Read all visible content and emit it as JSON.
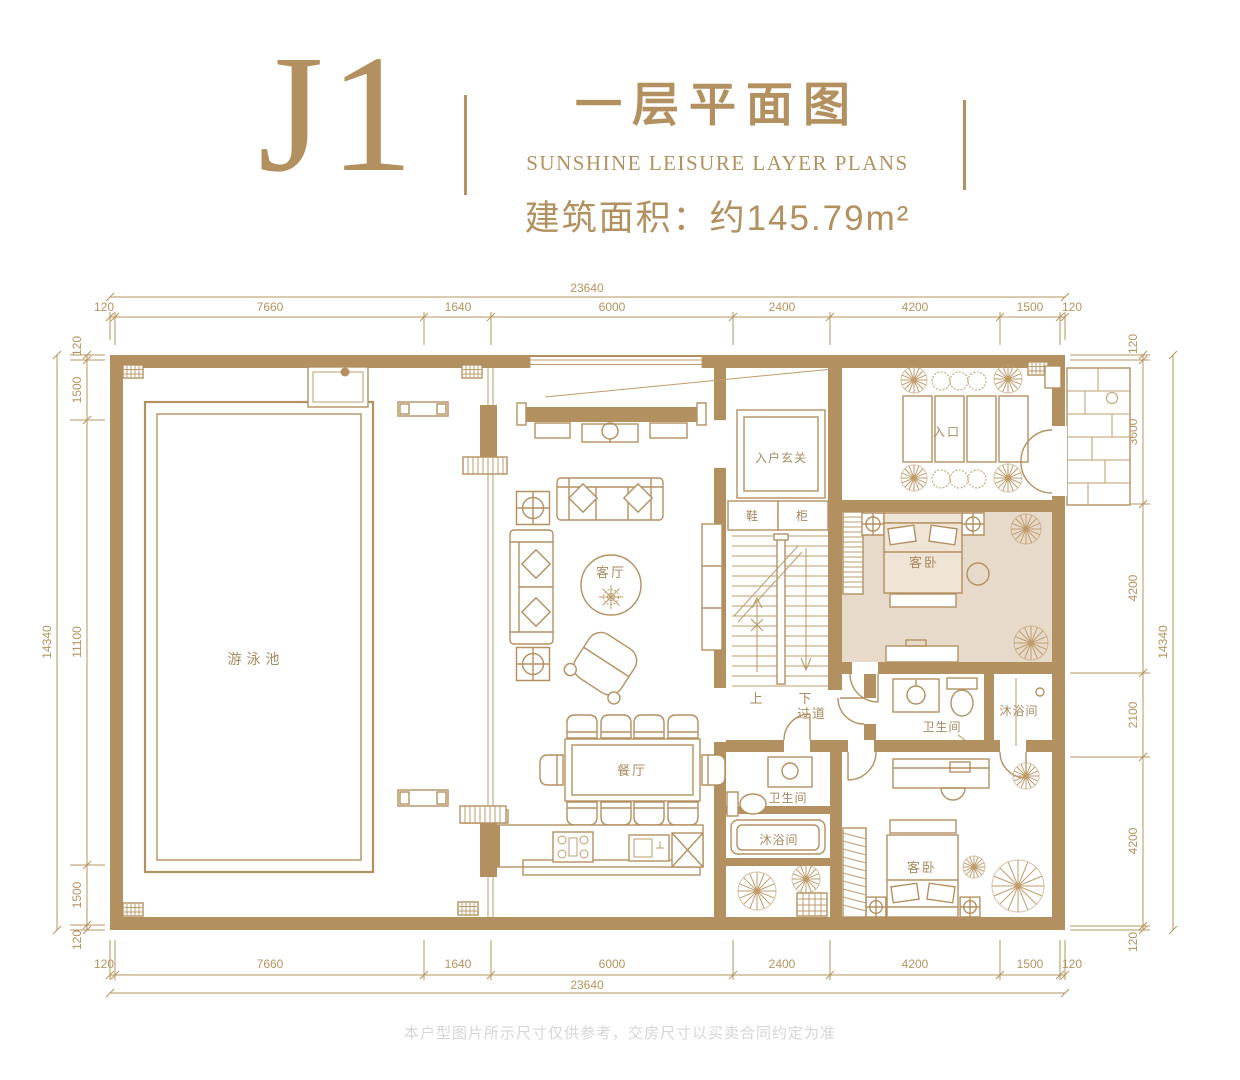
{
  "header": {
    "unit": "J1",
    "title": "一层平面图",
    "subtitle": "SUNSHINE LEISURE LAYER PLANS",
    "area": "建筑面积：约145.79m²"
  },
  "rooms": {
    "pool": "游泳池",
    "living": "客厅",
    "dining": "餐厅",
    "foyer": "入户玄关",
    "shoe_left": "鞋",
    "shoe_right": "柜",
    "entrance": "入口",
    "bedroom1": "客卧",
    "bath1": "卫生间",
    "shower1": "沐浴间",
    "corridor": "过道",
    "up": "上",
    "down": "下",
    "bath2": "卫生间",
    "shower2": "沐浴间",
    "bedroom2": "客卧"
  },
  "dims": {
    "top": {
      "total": "23640",
      "segments": [
        "120",
        "7660",
        "1640",
        "6000",
        "2400",
        "4200",
        "1500",
        "120"
      ]
    },
    "bottom": {
      "total": "23640",
      "segments": [
        "120",
        "7660",
        "1640",
        "6000",
        "2400",
        "4200",
        "1500",
        "120"
      ]
    },
    "left": {
      "total": "14340",
      "segments": [
        "120",
        "1500",
        "11100",
        "1500",
        "120"
      ]
    },
    "right": {
      "total": "14340",
      "segments": [
        "120",
        "3600",
        "4200",
        "2100",
        "4200",
        "120"
      ]
    }
  },
  "colors": {
    "gold": "#B2905F",
    "wall": "#B39060",
    "bedroom_fill": "#E8DACA",
    "footer_gray": "#D6D6D6"
  },
  "footer": {
    "disclaimer": "本户型图片所示尺寸仅供参考，交房尺寸以买卖合同约定为准"
  }
}
